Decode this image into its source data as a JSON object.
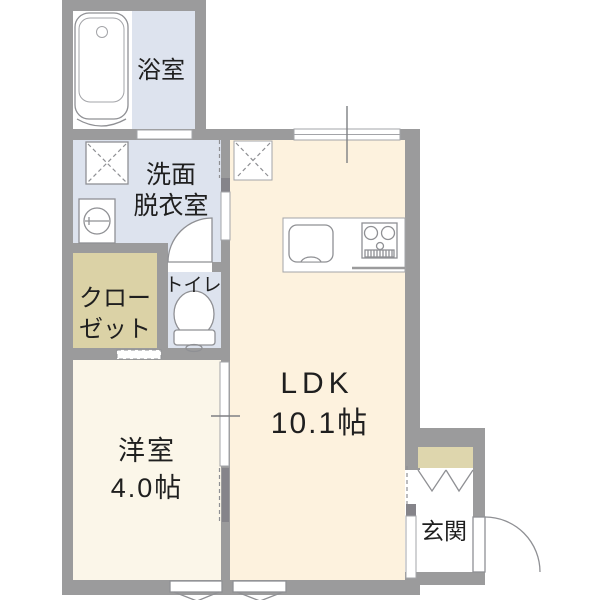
{
  "plan": {
    "type": "apartment-floor-plan",
    "rooms": {
      "bathroom": {
        "label": "浴室"
      },
      "washroom": {
        "label_line1": "洗面",
        "label_line2": "脱衣室"
      },
      "closet": {
        "label_line1": "クロー",
        "label_line2": "ゼット"
      },
      "toilet": {
        "label": "トイレ"
      },
      "ldk": {
        "label": "LDK",
        "area": "10.1帖"
      },
      "western_room": {
        "label": "洋室",
        "area": "4.0帖"
      },
      "entrance": {
        "label": "玄関"
      }
    },
    "colors": {
      "background": "#ffffff",
      "wall": "#9b9b9c",
      "wet_area_floor": "#dde3ee",
      "ldk_floor": "#fdf2de",
      "bedroom_floor": "#fbf6e9",
      "closet_floor": "#dbd2a6",
      "shoe_cabinet": "#ded6ad",
      "door_panel": "#85848a",
      "text": "#1f1f1f"
    },
    "fixtures": [
      "bathtub",
      "washing-machine-pan",
      "washbasin",
      "toilet-bowl",
      "kitchen-sink",
      "gas-stove",
      "refrigerator-space",
      "shoe-cabinet",
      "swing-doors",
      "sliding-doors",
      "window",
      "floor-vents"
    ]
  }
}
